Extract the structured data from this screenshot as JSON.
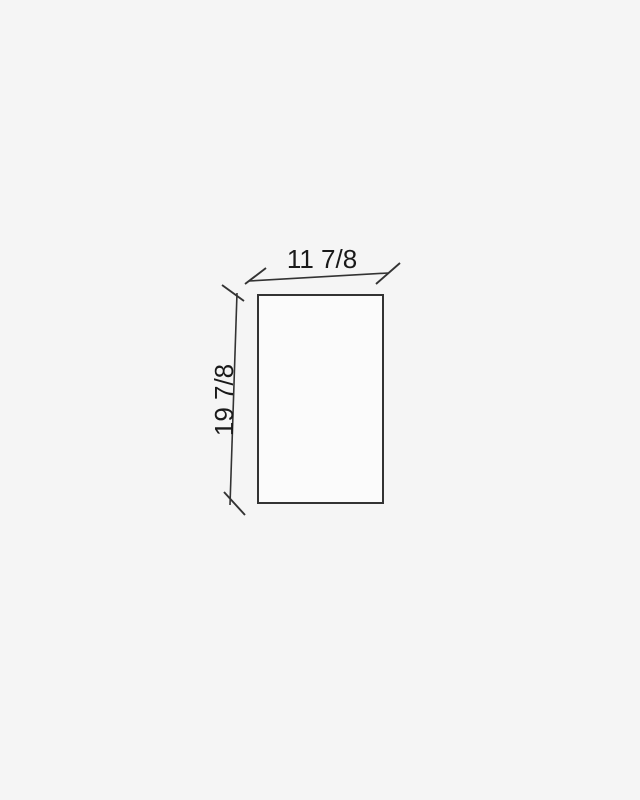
{
  "colors": {
    "background": "#f5f5f5",
    "line": "#333333",
    "text": "#1a1a1a",
    "shape-fill": "#fbfbfb"
  },
  "drawing": {
    "type": "dimension-diagram",
    "shape": "rectangle",
    "width": {
      "label": "11 7/8",
      "value": 11.875
    },
    "height": {
      "label": "19 7/8",
      "value": 19.875
    }
  }
}
